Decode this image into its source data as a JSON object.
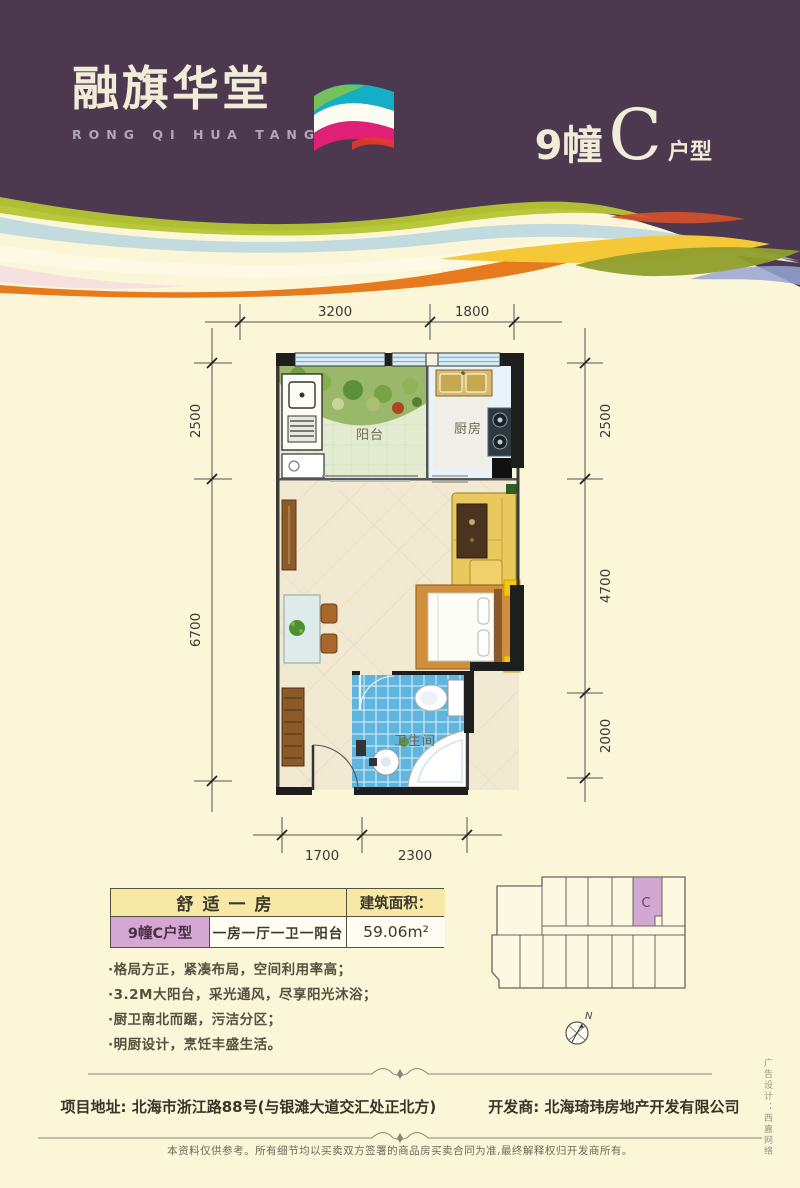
{
  "header": {
    "logo_cn": "融旗华堂",
    "logo_en": "RONG QI HUA TANG",
    "building": "9幢",
    "unit_letter": "C",
    "unit_type_suffix": "户型"
  },
  "floorplan": {
    "room_labels": {
      "balcony": "阳台",
      "kitchen": "厨房",
      "bathroom": "卫生间"
    },
    "dimensions": {
      "top": [
        "3200",
        "1800"
      ],
      "bottom": [
        "1700",
        "2300"
      ],
      "left": [
        "2500",
        "6700"
      ],
      "right": [
        "2500",
        "4700",
        "2000"
      ]
    }
  },
  "info_table": {
    "headline": "舒适一房",
    "area_label": "建筑面积：",
    "unit_name": "9幢C户型",
    "layout": "一房一厅一卫一阳台",
    "area_value": "59.06m²"
  },
  "features": [
    "·格局方正，紧凑布局，空间利用率高；",
    "·3.2M大阳台，采光通风，尽享阳光沐浴；",
    "·厨卫南北而踞，污洁分区；",
    "·明厨设计，烹饪丰盛生活。"
  ],
  "keyplan": {
    "highlight_label": "C",
    "compass_label": "N"
  },
  "footer": {
    "address": "项目地址: 北海市浙江路88号(与银滩大道交汇处正北方)",
    "developer": "开发商: 北海琦玮房地产开发有限公司",
    "disclaimer": "本资料仅供参考。所有细节均以买卖双方签署的商品房买卖合同为准,最终解释权归开发商所有。",
    "design_credit": "广告设计：西嘉网络"
  },
  "colors": {
    "header_purple": "#4c3950",
    "page_cream": "#fbf6d8",
    "table_yellow": "#f6e9a6",
    "highlight_lavender": "#d5a8d3",
    "bathroom_blue": "#5fb5de",
    "balcony_green": "#e3ecd1",
    "kitchen_blue": "#e8f3f9",
    "floor_beige": "#f2e9d2",
    "wave_orange": "#e87a1e",
    "wave_olive": "#b5c531"
  }
}
